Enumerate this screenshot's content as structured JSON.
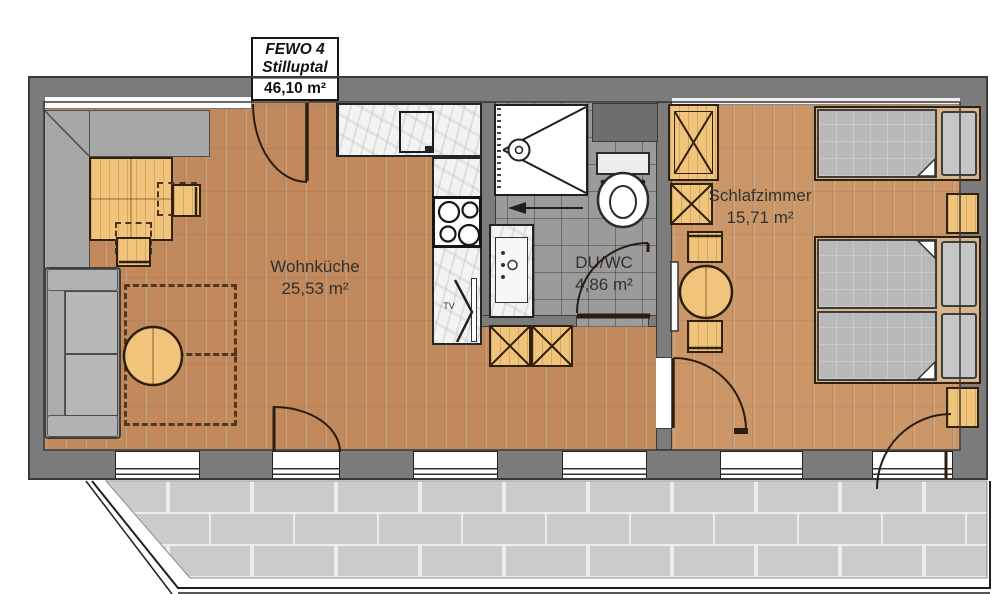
{
  "plan": {
    "title_box": {
      "project": "FEWO 4",
      "location": "Stilluptal",
      "total_area": "46,10 m²"
    },
    "rooms": [
      {
        "id": "living-kitchen",
        "name": "Wohnküche",
        "area": "25,53 m²"
      },
      {
        "id": "shower-wc",
        "name": "DU/WC",
        "area": "4,86 m²"
      },
      {
        "id": "bedroom",
        "name": "Schlafzimmer",
        "area": "15,71 m²"
      }
    ],
    "labels": {
      "tv": "TV"
    },
    "colors": {
      "wall": "#7c7c7c",
      "wood_floor": "#c28a5c",
      "bedroom_floor": "#cc9768",
      "furniture_wood": "#f1c47c",
      "tile_floor": "#9b9b9b",
      "mattress": "#b9b9b9",
      "bench": "#a7a7a7",
      "sofa": "#9e9e9e",
      "terrace_paver": "#cbcbcb",
      "outline": "#2b1d10"
    }
  }
}
